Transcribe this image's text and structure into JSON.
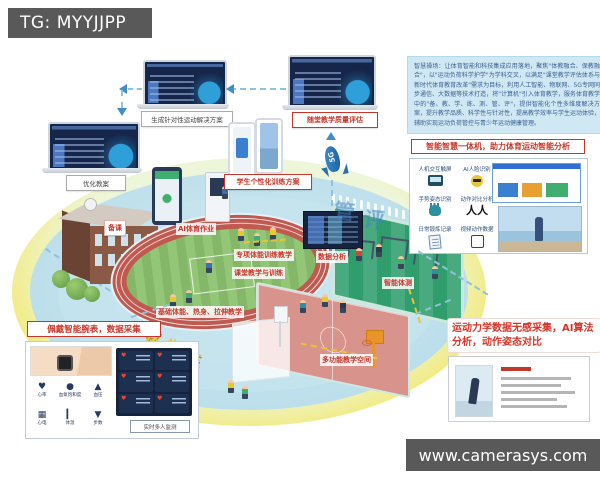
{
  "watermarks": {
    "top": "TG: MYYJJPP",
    "bottom": "www.camerasys.com"
  },
  "devices": {
    "laptop_main_label": "生成针对性运动解决方案",
    "laptop_left_label": "优化教案",
    "laptop_right_label": "随堂教学质量评估",
    "phones_label": "学生个性化训练方案",
    "rocket_label": "5G"
  },
  "info_box": {
    "text": "智慧操场：让体育智能和科技集成应用落地，聚焦\"体教融合、保教融合\"，以\"运动负荷科学护学\"为学科交叉，以满足\"课堂教学评估体系与新时代体育教育改革\"需求为目标，利用人工智能、物联网、5G专网同步通信、大数据等技术打造，将\"计算机\"引入体育教学，服务体育教学中的\"备、教、学、练、测、管、评\"，提供智能化个性多维度解决方案，提升教学品质、科学性与针对性，提高教学效率与学生运动体验，辅助实现运动负荷管控与青少年运动健康管理。"
  },
  "smart_box": {
    "title": "智能智慧一体机，助力体育运动智能分析",
    "features": [
      "人机交互触屏",
      "AI人脸识别",
      "手势姿态识别",
      "动作对比分析",
      "日常锻炼记录",
      "视频动作数据"
    ]
  },
  "scene": {
    "labels": {
      "lesson_prep": "备课",
      "ai_homework": "AI体育作业",
      "special_training": "专项体能训练教学",
      "classroom_training": "课堂教学与训练",
      "data_analysis": "数据分析",
      "smart_fitness_test": "智能体测",
      "basic_fitness": "基础体能、热身、拉伸教学",
      "multi_space": "多功能教学空间"
    },
    "big_chars_yellow": [
      "教",
      "学",
      "练"
    ],
    "big_chars_blue": [
      "管",
      "评"
    ]
  },
  "wristband": {
    "title": "佩戴智能腕表，数据采集",
    "metrics": [
      "心率",
      "血氧饱和度",
      "血压",
      "心电",
      "体温",
      "步数"
    ],
    "monitor_caption": "实时多人监测"
  },
  "kinematics": {
    "title": "运动力学数据无感采集，AI算法分析，动作姿态对比"
  },
  "colors": {
    "accent_red": "#c8362b",
    "track_red": "#c05a50",
    "court_green": "#2f9e6c",
    "court_pink": "#d9938d",
    "platform_blue": "#bcdfeb",
    "screen_navy": "#16264a",
    "info_blue": "#cfe8f4"
  }
}
